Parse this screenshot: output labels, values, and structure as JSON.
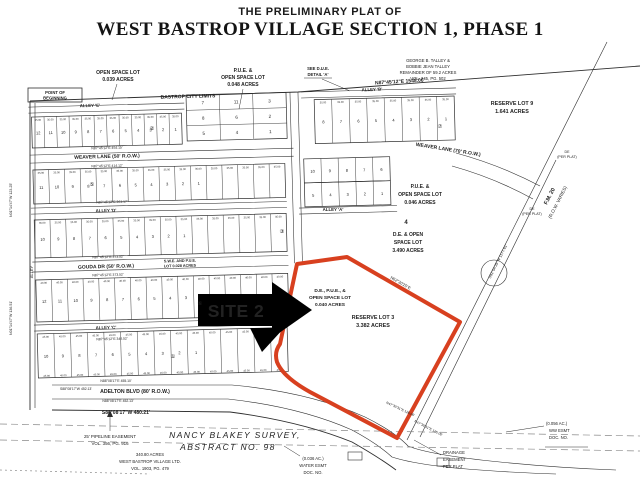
{
  "title": {
    "line1": "THE PRELIMINARY PLAT OF",
    "line2": "WEST BASTROP VILLAGE SECTION 1, PHASE 1"
  },
  "site_marker": {
    "label": "SITE 2"
  },
  "colors": {
    "highlight_red": "#d8401f",
    "ink": "#2e2e2e",
    "dim_text": "#555555",
    "survey_gray": "#bdb8b0"
  },
  "labels": [
    {
      "id": "pob-line1",
      "t": "POINT OF",
      "x": 55,
      "y": 94,
      "s": 4.2,
      "b": 1
    },
    {
      "id": "pob-line2",
      "t": "BEGINNING",
      "x": 55,
      "y": 99.5,
      "s": 4.2,
      "b": 1
    },
    {
      "id": "open-space-e-1",
      "t": "OPEN SPACE LOT",
      "x": 118,
      "y": 74,
      "s": 5,
      "b": 1
    },
    {
      "id": "open-space-e-2",
      "t": "0.039 ACRES",
      "x": 118,
      "y": 81,
      "s": 5,
      "b": 1
    },
    {
      "id": "bastrop-city-limits",
      "t": "BASTROP CITY LIMITS",
      "x": 188,
      "y": 98,
      "s": 5,
      "b": 1,
      "r": -1.5
    },
    {
      "id": "alley-e",
      "t": "ALLEY 'E'",
      "x": 90,
      "y": 107,
      "s": 4.4,
      "b": 1,
      "r": -1.5
    },
    {
      "id": "pue-048-1",
      "t": "P.U.E. &",
      "x": 243,
      "y": 72,
      "s": 5,
      "b": 1
    },
    {
      "id": "pue-048-2",
      "t": "OPEN SPACE LOT",
      "x": 243,
      "y": 79,
      "s": 5,
      "b": 1
    },
    {
      "id": "pue-048-3",
      "t": "0.048 ACRES",
      "x": 243,
      "y": 86,
      "s": 5,
      "b": 1
    },
    {
      "id": "see-due-1",
      "t": "SEE D.U.E.",
      "x": 318,
      "y": 70,
      "s": 4.2,
      "b": 1
    },
    {
      "id": "see-due-2",
      "t": "DETAIL 'A'",
      "x": 318,
      "y": 76,
      "s": 4.2,
      "b": 1
    },
    {
      "id": "bearing-north",
      "t": "N87°45'12\"E  1548.06'",
      "x": 400,
      "y": 83,
      "s": 5,
      "b": 1,
      "r": -3.5
    },
    {
      "id": "talley-1",
      "t": "GEORGE B. TALLEY &",
      "x": 428,
      "y": 62,
      "s": 4.2
    },
    {
      "id": "talley-2",
      "t": "BOBBIE JEAN TALLEY",
      "x": 428,
      "y": 68,
      "s": 4.2
    },
    {
      "id": "talley-3",
      "t": "REMAINDER OF 59.2 ACRES",
      "x": 428,
      "y": 74,
      "s": 4.2
    },
    {
      "id": "talley-4",
      "t": "VOL. 245, PG. 502",
      "x": 428,
      "y": 80,
      "s": 4.2
    },
    {
      "id": "reserve-lot9-1",
      "t": "RESERVE LOT 9",
      "x": 512,
      "y": 105,
      "s": 5.4,
      "b": 1
    },
    {
      "id": "reserve-lot9-2",
      "t": "1.641 ACRES",
      "x": 512,
      "y": 113,
      "s": 5.4,
      "b": 1
    },
    {
      "id": "alley-b",
      "t": "ALLEY 'B'",
      "x": 372,
      "y": 91,
      "s": 4.4,
      "b": 1,
      "r": -2
    },
    {
      "id": "weaver-lane-70",
      "t": "WEAVER LANE (70' R.O.W.)",
      "x": 448,
      "y": 151,
      "s": 5,
      "b": 1,
      "r": 9
    },
    {
      "id": "weaver-lane-50",
      "t": "WEAVER LANE (50' R.O.W.)",
      "x": 107,
      "y": 158,
      "s": 5,
      "b": 1,
      "r": -1.5
    },
    {
      "id": "brg-weaver-top",
      "t": "N87°45'12\"E 454.15'",
      "x": 107,
      "y": 149,
      "s": 3.4,
      "r": -1.5
    },
    {
      "id": "brg-weaver-bot",
      "t": "N87°45'12\"E 414.12'",
      "x": 107,
      "y": 167,
      "s": 3.4,
      "r": -1.5
    },
    {
      "id": "alley-d",
      "t": "ALLEY 'D'",
      "x": 106,
      "y": 212,
      "s": 4.4,
      "b": 1,
      "r": -1.5
    },
    {
      "id": "brg-alley-d",
      "t": "N87°45'12\"E 361.17'",
      "x": 112,
      "y": 203,
      "s": 3.4,
      "r": -1.5
    },
    {
      "id": "gouda-dr",
      "t": "GOUDA DR (50' R.O.W.)",
      "x": 106,
      "y": 268,
      "s": 5,
      "b": 1,
      "r": -1.5
    },
    {
      "id": "brg-gouda-top",
      "t": "N87°45'12\"E 373.52'",
      "x": 108,
      "y": 258,
      "s": 3.4,
      "r": -1.5
    },
    {
      "id": "brg-gouda-bot",
      "t": "N87°45'12\"E 373.52'",
      "x": 108,
      "y": 276,
      "s": 3.4,
      "r": -1.5
    },
    {
      "id": "alley-c",
      "t": "ALLEY 'C'",
      "x": 106,
      "y": 329,
      "s": 4.4,
      "b": 1,
      "r": -1.5
    },
    {
      "id": "brg-alley-c",
      "t": "N87°45'12\"E 346.52'",
      "x": 112,
      "y": 340,
      "s": 3.4,
      "r": -1.5
    },
    {
      "id": "swe-pue-1",
      "t": "S.W.E. AND P.U.E.",
      "x": 180,
      "y": 262,
      "s": 3.8,
      "b": 1,
      "r": -1.5
    },
    {
      "id": "swe-pue-2",
      "t": "LOT 0.028 ACRES",
      "x": 180,
      "y": 267,
      "s": 3.8,
      "b": 1,
      "r": -1.5
    },
    {
      "id": "alley-a",
      "t": "ALLEY 'A'",
      "x": 333,
      "y": 211,
      "s": 4.4,
      "b": 1
    },
    {
      "id": "pue-046-1",
      "t": "P.U.E. &",
      "x": 420,
      "y": 188,
      "s": 5,
      "b": 1
    },
    {
      "id": "pue-046-2",
      "t": "OPEN SPACE LOT",
      "x": 420,
      "y": 196,
      "s": 5,
      "b": 1
    },
    {
      "id": "pue-046-3",
      "t": "0.046 ACRES",
      "x": 420,
      "y": 204,
      "s": 5,
      "b": 1
    },
    {
      "id": "lot-4",
      "t": "4",
      "x": 406,
      "y": 224,
      "s": 6,
      "b": 1
    },
    {
      "id": "de-open-1",
      "t": "D.E. & OPEN",
      "x": 408,
      "y": 236,
      "s": 5,
      "b": 1
    },
    {
      "id": "de-open-2",
      "t": "SPACE LOT",
      "x": 408,
      "y": 244,
      "s": 5,
      "b": 1
    },
    {
      "id": "de-open-3",
      "t": "3.490 ACRES",
      "x": 408,
      "y": 252,
      "s": 5,
      "b": 1
    },
    {
      "id": "de-pue-040-1",
      "t": "D.E., P.U.E., &",
      "x": 330,
      "y": 292,
      "s": 4.8,
      "b": 1
    },
    {
      "id": "de-pue-040-2",
      "t": "OPEN SPACE LOT",
      "x": 330,
      "y": 299,
      "s": 4.8,
      "b": 1
    },
    {
      "id": "de-pue-040-3",
      "t": "0.040 ACRES",
      "x": 330,
      "y": 306,
      "s": 4.8,
      "b": 1
    },
    {
      "id": "reserve-lot3-1",
      "t": "RESERVE LOT 3",
      "x": 373,
      "y": 319,
      "s": 5.4,
      "b": 1
    },
    {
      "id": "reserve-lot3-2",
      "t": "3.382 ACRES",
      "x": 373,
      "y": 327,
      "s": 5.4,
      "b": 1
    },
    {
      "id": "brg-red-edge",
      "t": "N62°30'25\"E",
      "x": 400,
      "y": 284,
      "s": 4,
      "r": 30
    },
    {
      "id": "fm20-name",
      "t": "F.M. 20",
      "x": 551,
      "y": 197,
      "s": 5.5,
      "b": 1,
      "r": -63
    },
    {
      "id": "fm20-row",
      "t": "(R.O.W. VARIES)",
      "x": 559,
      "y": 203,
      "s": 4.6,
      "r": -63
    },
    {
      "id": "brg-fm20",
      "t": "S02°04'35\"W 1177.61'",
      "x": 499,
      "y": 262,
      "s": 3.8,
      "r": -63
    },
    {
      "id": "adelton-blvd",
      "t": "ADELTON BLVD (80' R.O.W.)",
      "x": 135,
      "y": 393,
      "s": 5.2,
      "b": 1
    },
    {
      "id": "brg-adelton-top",
      "t": "N88°08'17\"E 455.10'",
      "x": 116,
      "y": 382,
      "s": 3.4
    },
    {
      "id": "brg-452-left",
      "t": "S88°08'17\"W 452.13'",
      "x": 76,
      "y": 390,
      "s": 3.4
    },
    {
      "id": "brg-adelton-bot",
      "t": "N88°08'17\"E 452.13'",
      "x": 118,
      "y": 402,
      "s": 3.4
    },
    {
      "id": "boundary-480",
      "t": "S88°08'17\"W  480.21'",
      "x": 126,
      "y": 414,
      "s": 5,
      "b": 1
    },
    {
      "id": "pipeline-1",
      "t": "25' PIPELINE EASEMENT",
      "x": 110,
      "y": 438,
      "s": 4.4
    },
    {
      "id": "pipeline-2",
      "t": "VOL. 356, PG. 916",
      "x": 110,
      "y": 445,
      "s": 4.4
    },
    {
      "id": "survey-name-1",
      "t": "NANCY BLAKEY SURVEY,",
      "x": 235,
      "y": 438,
      "s": 8.5,
      "i": 1,
      "c": "gray",
      "ls": 1.4,
      "f": "serif"
    },
    {
      "id": "survey-name-2",
      "t": "ABSTRACT NO. 98",
      "x": 228,
      "y": 450,
      "s": 8.5,
      "i": 1,
      "c": "gray",
      "ls": 1.4,
      "f": "serif"
    },
    {
      "id": "wbv-1",
      "t": "340.80 ACRES",
      "x": 150,
      "y": 456,
      "s": 4.2
    },
    {
      "id": "wbv-2",
      "t": "WEST BASTROP VILLAGE LTD.",
      "x": 150,
      "y": 463,
      "s": 4.2
    },
    {
      "id": "wbv-3",
      "t": "VOL. 1903, PG. 479",
      "x": 150,
      "y": 470,
      "s": 4.2
    },
    {
      "id": "drainage-1",
      "t": "DRAINAGE",
      "x": 443,
      "y": 454,
      "s": 4.2,
      "a": "start"
    },
    {
      "id": "drainage-2",
      "t": "EASEMENT",
      "x": 443,
      "y": 461,
      "s": 4.2,
      "a": "start"
    },
    {
      "id": "drainage-3",
      "t": "PER PLAT",
      "x": 443,
      "y": 468,
      "s": 4.2,
      "a": "start"
    },
    {
      "id": "ww-esmt-1",
      "t": "(0.056 AC.)",
      "x": 546,
      "y": 425,
      "s": 4.2,
      "a": "start"
    },
    {
      "id": "ww-esmt-2",
      "t": "WW ESMT",
      "x": 549,
      "y": 432,
      "s": 4.2,
      "a": "start"
    },
    {
      "id": "ww-esmt-3",
      "t": "DOC. NO.",
      "x": 549,
      "y": 439,
      "s": 4.2,
      "a": "start"
    },
    {
      "id": "water-esmt-1",
      "t": "(0.036 AC.)",
      "x": 313,
      "y": 460,
      "s": 4.2
    },
    {
      "id": "water-esmt-2",
      "t": "WATER ESMT",
      "x": 313,
      "y": 467,
      "s": 4.2
    },
    {
      "id": "water-esmt-3",
      "t": "DOC. NO.",
      "x": 313,
      "y": 474,
      "s": 4.2
    },
    {
      "id": "brg-west-1",
      "t": "N01°14'47\"W 123.25'",
      "x": 12,
      "y": 200,
      "s": 3.6,
      "r": -90
    },
    {
      "id": "brg-west-2",
      "t": "N01°14'47\"W 136.51'",
      "x": 12,
      "y": 318,
      "s": 3.6,
      "r": -90
    },
    {
      "id": "alley-west",
      "t": "ALLEY",
      "x": 33,
      "y": 272,
      "s": 4,
      "r": -90
    },
    {
      "id": "brg-road-1",
      "t": "N47°30'31\"E 126.06'",
      "x": 400,
      "y": 410,
      "s": 3.4,
      "r": 25
    },
    {
      "id": "brg-road-2",
      "t": "N47°30'31\"E 126.06'",
      "x": 428,
      "y": 429,
      "s": 3.4,
      "r": 27
    },
    {
      "id": "de-per-plat-1a",
      "t": "DE",
      "x": 567,
      "y": 153,
      "s": 3.6
    },
    {
      "id": "de-per-plat-1b",
      "t": "(PER PLAT)",
      "x": 567,
      "y": 158,
      "s": 3.6
    },
    {
      "id": "de-per-plat-2a",
      "t": "DE",
      "x": 532,
      "y": 210,
      "s": 3.6
    },
    {
      "id": "de-per-plat-2b",
      "t": "(PER PLAT)",
      "x": 532,
      "y": 215,
      "s": 3.6
    }
  ],
  "lot_bands": [
    {
      "id": "band-weaver-north",
      "x": 35,
      "y": 117,
      "w": 150,
      "h": 31,
      "dims": "35.00",
      "nums": [
        "12",
        "11",
        "10",
        "9",
        "8",
        "7",
        "6",
        "5",
        "4",
        "3",
        "2",
        "1"
      ]
    },
    {
      "id": "band-weaver-south",
      "x": 35,
      "y": 170,
      "w": 252,
      "h": 34,
      "dims": "35.00",
      "nums": [
        "11",
        "10",
        "9",
        "8",
        "7",
        "6",
        "5",
        "4",
        "3",
        "2",
        "1",
        "",
        "",
        "",
        "",
        ""
      ]
    },
    {
      "id": "band-alley-d-south",
      "x": 35,
      "y": 220,
      "w": 252,
      "h": 38,
      "dims": "35.00",
      "nums": [
        "10",
        "9",
        "8",
        "7",
        "6",
        "5",
        "4",
        "3",
        "2",
        "1",
        "",
        "",
        "",
        "",
        "",
        ""
      ]
    },
    {
      "id": "band-gouda-south",
      "x": 35,
      "y": 280,
      "w": 252,
      "h": 42,
      "dims": "40.00",
      "nums": [
        "12",
        "11",
        "10",
        "9",
        "8",
        "7",
        "6",
        "5",
        "4",
        "3",
        "2",
        "1",
        "",
        "",
        "",
        ""
      ]
    },
    {
      "id": "band-adelton-north",
      "x": 35,
      "y": 334,
      "w": 250,
      "h": 44,
      "dims": "45.00",
      "dims_bottom": "45.00",
      "nums": [
        "10",
        "9",
        "8",
        "7",
        "6",
        "5",
        "4",
        "3",
        "2",
        "1",
        "",
        "",
        "",
        "",
        ""
      ]
    },
    {
      "id": "band-alley-b-south",
      "x": 318,
      "y": 107,
      "w": 140,
      "h": 44,
      "dims": "35.00",
      "nums": [
        "8",
        "7",
        "6",
        "5",
        "4",
        "3",
        "2",
        "1"
      ]
    },
    {
      "id": "band-alley-a-north1",
      "x": 306,
      "y": 166,
      "w": 86,
      "h": 24,
      "nums": [
        "10",
        "9",
        "8",
        "7",
        "6"
      ]
    },
    {
      "id": "band-alley-a-north2",
      "x": 306,
      "y": 190,
      "w": 86,
      "h": 24,
      "nums": [
        "5",
        "4",
        "3",
        "2",
        "1"
      ]
    }
  ],
  "grids": [
    {
      "id": "block-center",
      "x": 190,
      "y": 99,
      "w": 100,
      "h": 46,
      "cols": 3,
      "rows": 3,
      "nums": [
        "7",
        "11",
        "3",
        "8",
        "6",
        "2",
        "5",
        "4",
        "1"
      ]
    }
  ],
  "circled": [
    {
      "t": "②",
      "x": 152,
      "y": 130
    },
    {
      "t": "⑤",
      "x": 92,
      "y": 186
    },
    {
      "t": "③",
      "x": 282,
      "y": 233
    },
    {
      "t": "⑥",
      "x": 200,
      "y": 305
    },
    {
      "t": "①",
      "x": 173,
      "y": 358
    },
    {
      "t": "⑦",
      "x": 440,
      "y": 128
    }
  ]
}
